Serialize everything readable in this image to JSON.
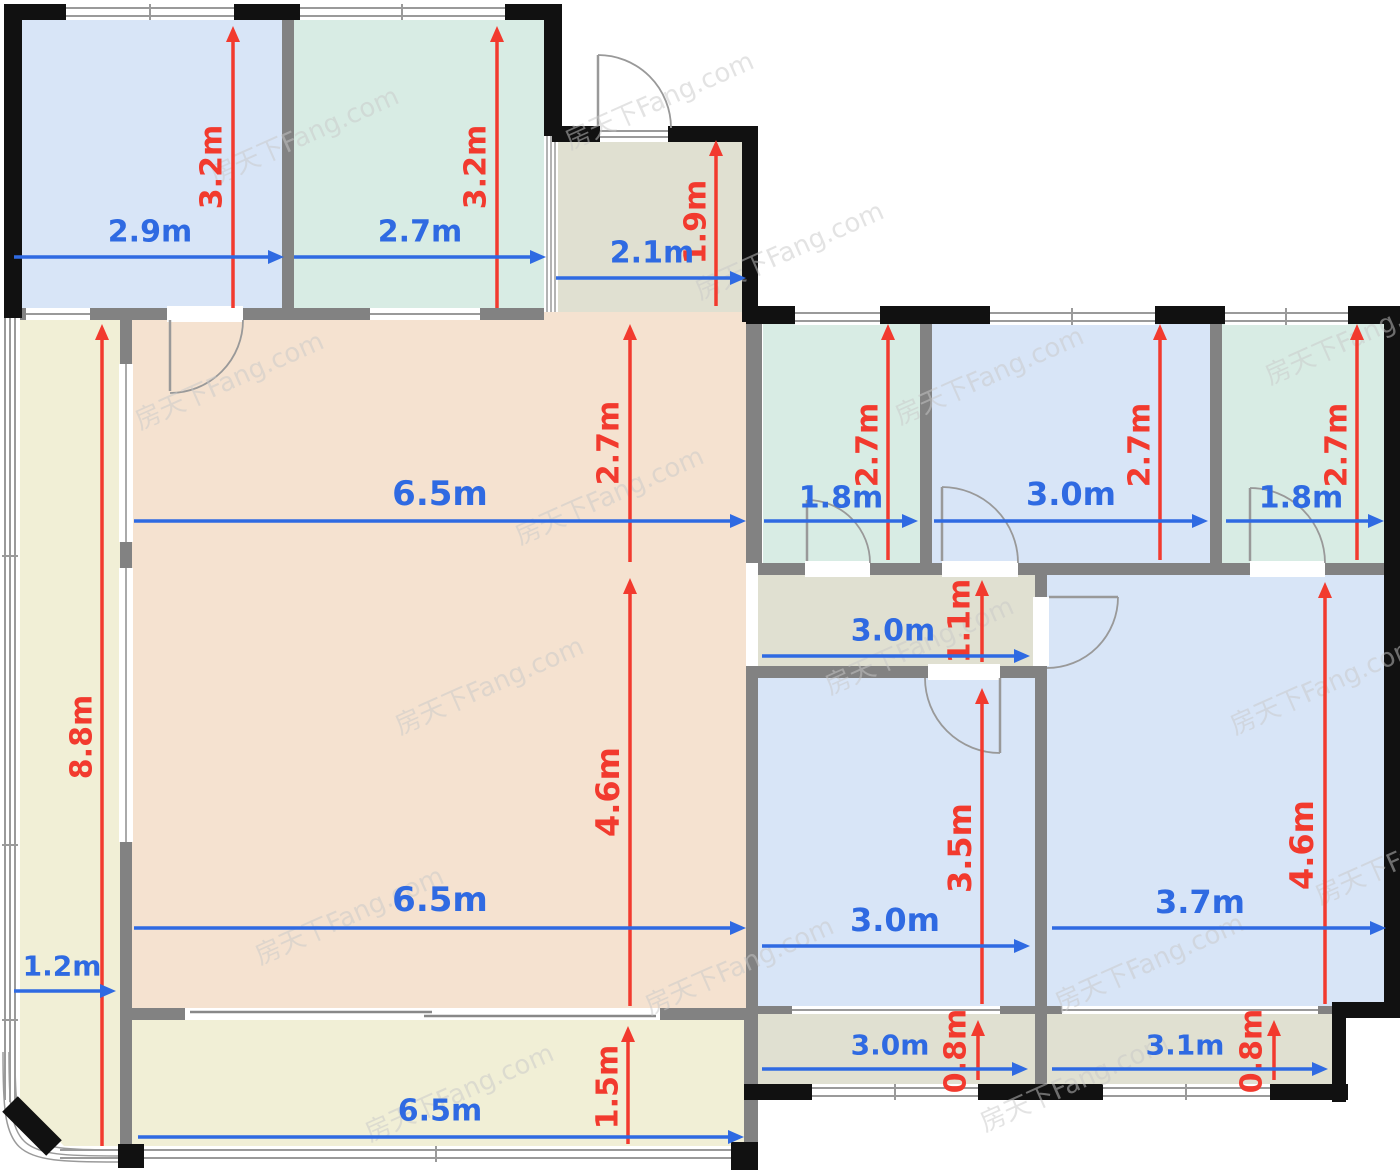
{
  "title": "apartment-floor-plan",
  "watermark": {
    "text": "房天下Fang.com",
    "positions": [
      [
        215,
        185
      ],
      [
        570,
        150
      ],
      [
        140,
        430
      ],
      [
        520,
        545
      ],
      [
        900,
        425
      ],
      [
        1270,
        385
      ],
      [
        400,
        735
      ],
      [
        830,
        695
      ],
      [
        1235,
        735
      ],
      [
        260,
        965
      ],
      [
        650,
        1015
      ],
      [
        1060,
        1012
      ],
      [
        370,
        1142
      ],
      [
        985,
        1132
      ],
      [
        1320,
        905
      ],
      [
        700,
        300
      ]
    ],
    "rotation": -24,
    "font_size": 26
  },
  "colors": {
    "room_blue": "#d8e5f7",
    "room_teal": "#d8ece4",
    "room_peach": "#f5e2d0",
    "room_cream": "#f1efd6",
    "room_olive": "#e0e0d1",
    "arrow_red": "#f23a2e",
    "arrow_blue": "#2f6ae2",
    "wall_black": "#111111",
    "wall_gray": "#828282",
    "watermark_color": "#c9c9c9"
  },
  "dimensions": [
    {
      "label": "3.2m",
      "axis": "v",
      "x": 233,
      "y1": 26,
      "y2": 308,
      "lx": 212,
      "ly": 167,
      "size": 30
    },
    {
      "label": "3.2m",
      "axis": "v",
      "x": 497,
      "y1": 26,
      "y2": 308,
      "lx": 476,
      "ly": 167,
      "size": 30
    },
    {
      "label": "1.9m",
      "axis": "v",
      "x": 716,
      "y1": 140,
      "y2": 306,
      "lx": 696,
      "ly": 222,
      "size": 30
    },
    {
      "label": "2.7m",
      "axis": "v",
      "x": 630,
      "y1": 324,
      "y2": 562,
      "lx": 609,
      "ly": 443,
      "size": 30
    },
    {
      "label": "4.6m",
      "axis": "v",
      "x": 630,
      "y1": 578,
      "y2": 1006,
      "lx": 608,
      "ly": 792,
      "size": 32
    },
    {
      "label": "8.8m",
      "axis": "v",
      "x": 102,
      "y1": 324,
      "y2": 1146,
      "lx": 82,
      "ly": 737,
      "size": 30
    },
    {
      "label": "1.5m",
      "axis": "v",
      "x": 628,
      "y1": 1026,
      "y2": 1144,
      "lx": 608,
      "ly": 1087,
      "size": 30
    },
    {
      "label": "2.7m",
      "axis": "v",
      "x": 888,
      "y1": 324,
      "y2": 560,
      "lx": 868,
      "ly": 445,
      "size": 30
    },
    {
      "label": "2.7m",
      "axis": "v",
      "x": 1160,
      "y1": 324,
      "y2": 560,
      "lx": 1140,
      "ly": 445,
      "size": 30
    },
    {
      "label": "2.7m",
      "axis": "v",
      "x": 1357,
      "y1": 324,
      "y2": 560,
      "lx": 1337,
      "ly": 445,
      "size": 30
    },
    {
      "label": "1.1m",
      "axis": "v",
      "x": 982,
      "y1": 580,
      "y2": 662,
      "lx": 960,
      "ly": 621,
      "size": 30
    },
    {
      "label": "3.5m",
      "axis": "v",
      "x": 982,
      "y1": 688,
      "y2": 1004,
      "lx": 960,
      "ly": 848,
      "size": 32
    },
    {
      "label": "4.6m",
      "axis": "v",
      "x": 1325,
      "y1": 582,
      "y2": 1004,
      "lx": 1302,
      "ly": 845,
      "size": 32
    },
    {
      "label": "0.8m",
      "axis": "v",
      "x": 978,
      "y1": 1020,
      "y2": 1080,
      "lx": 956,
      "ly": 1051,
      "size": 30
    },
    {
      "label": "0.8m",
      "axis": "v",
      "x": 1274,
      "y1": 1020,
      "y2": 1080,
      "lx": 1252,
      "ly": 1051,
      "size": 30
    },
    {
      "label": "2.9m",
      "axis": "h",
      "y": 257,
      "x1": 14,
      "x2": 284,
      "lx": 150,
      "ly": 232,
      "size": 30
    },
    {
      "label": "2.7m",
      "axis": "h",
      "y": 257,
      "x1": 294,
      "x2": 546,
      "lx": 420,
      "ly": 232,
      "size": 30
    },
    {
      "label": "2.1m",
      "axis": "h",
      "y": 278,
      "x1": 556,
      "x2": 746,
      "lx": 652,
      "ly": 253,
      "size": 30
    },
    {
      "label": "6.5m",
      "axis": "h",
      "y": 521,
      "x1": 134,
      "x2": 746,
      "lx": 440,
      "ly": 494,
      "size": 34
    },
    {
      "label": "1.8m",
      "axis": "h",
      "y": 521,
      "x1": 764,
      "x2": 918,
      "lx": 841,
      "ly": 498,
      "size": 30
    },
    {
      "label": "3.0m",
      "axis": "h",
      "y": 521,
      "x1": 934,
      "x2": 1208,
      "lx": 1071,
      "ly": 494,
      "size": 32
    },
    {
      "label": "1.8m",
      "axis": "h",
      "y": 521,
      "x1": 1226,
      "x2": 1384,
      "lx": 1301,
      "ly": 498,
      "size": 30
    },
    {
      "label": "3.0m",
      "axis": "h",
      "y": 656,
      "x1": 762,
      "x2": 1030,
      "lx": 893,
      "ly": 631,
      "size": 30
    },
    {
      "label": "3.0m",
      "axis": "h",
      "y": 946,
      "x1": 762,
      "x2": 1030,
      "lx": 895,
      "ly": 920,
      "size": 32
    },
    {
      "label": "3.7m",
      "axis": "h",
      "y": 928,
      "x1": 1052,
      "x2": 1386,
      "lx": 1200,
      "ly": 902,
      "size": 32
    },
    {
      "label": "6.5m",
      "axis": "h",
      "y": 928,
      "x1": 134,
      "x2": 746,
      "lx": 440,
      "ly": 900,
      "size": 34
    },
    {
      "label": "1.2m",
      "axis": "h",
      "y": 991,
      "x1": 14,
      "x2": 116,
      "lx": 62,
      "ly": 966,
      "size": 28
    },
    {
      "label": "6.5m",
      "axis": "h",
      "y": 1137,
      "x1": 138,
      "x2": 744,
      "lx": 440,
      "ly": 1111,
      "size": 30
    },
    {
      "label": "3.0m",
      "axis": "h",
      "y": 1069,
      "x1": 762,
      "x2": 1028,
      "lx": 890,
      "ly": 1045,
      "size": 28
    },
    {
      "label": "3.1m",
      "axis": "h",
      "y": 1069,
      "x1": 1052,
      "x2": 1328,
      "lx": 1185,
      "ly": 1045,
      "size": 28
    }
  ]
}
